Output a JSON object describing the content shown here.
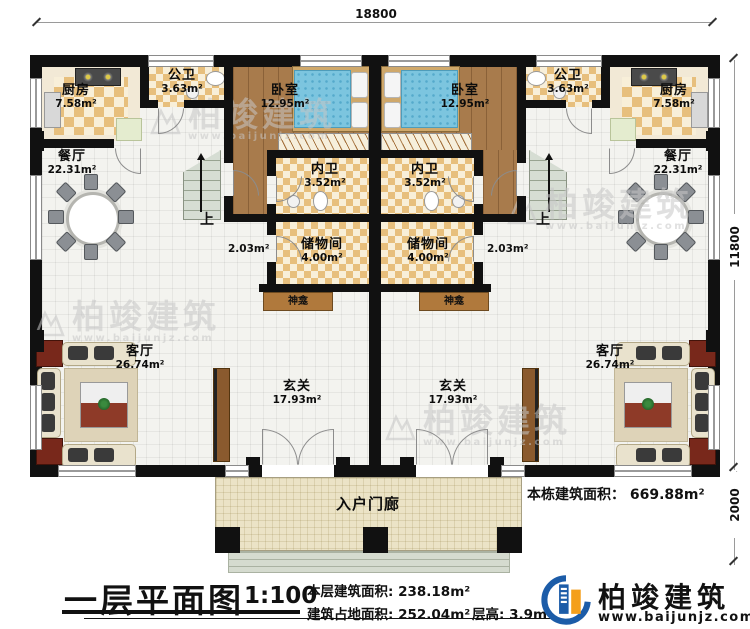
{
  "dimensions": {
    "top_width": "18800",
    "right_height": "11800",
    "porch_depth": "2000"
  },
  "rooms": {
    "kitchen": {
      "name": "厨房",
      "area": "7.58m²"
    },
    "public_bath": {
      "name": "公卫",
      "area": "3.63m²"
    },
    "bedroom": {
      "name": "卧室",
      "area": "12.95m²"
    },
    "dining": {
      "name": "餐厅",
      "area": "22.31m²"
    },
    "ensuite_bath": {
      "name": "内卫",
      "area": "3.52m²"
    },
    "storage": {
      "name": "储物间",
      "area": "4.00m²"
    },
    "closet": {
      "area": "2.03m²"
    },
    "shrine": {
      "name": "神龛"
    },
    "living": {
      "name": "客厅",
      "area": "26.74m²"
    },
    "foyer": {
      "name": "玄关",
      "area": "17.93m²"
    },
    "porch": {
      "name": "入户门廊"
    },
    "stairs": {
      "up": "上"
    }
  },
  "annotations": {
    "total_building_area": "本栋建筑面积： 669.88m²"
  },
  "title_block": {
    "title": "一层平面图",
    "scale": "1:100",
    "floor_area": "本层建筑面积: 238.18m²",
    "footprint": "建筑占地面积: 252.04m²",
    "height": "层高: 3.9m"
  },
  "branding": {
    "company": "柏竣建筑",
    "website": "www.baijunjz.com"
  },
  "watermark": {
    "text": "柏竣建筑",
    "url": "www.baijunjz.com"
  },
  "colors": {
    "wall": "#111111",
    "checker": "#e7bf7d",
    "wood": "#a87b4c",
    "bed": "#7cc5df",
    "porch": "#ebe3c6",
    "logo_blue": "#1c5ca8",
    "logo_orange": "#f49f1c"
  }
}
